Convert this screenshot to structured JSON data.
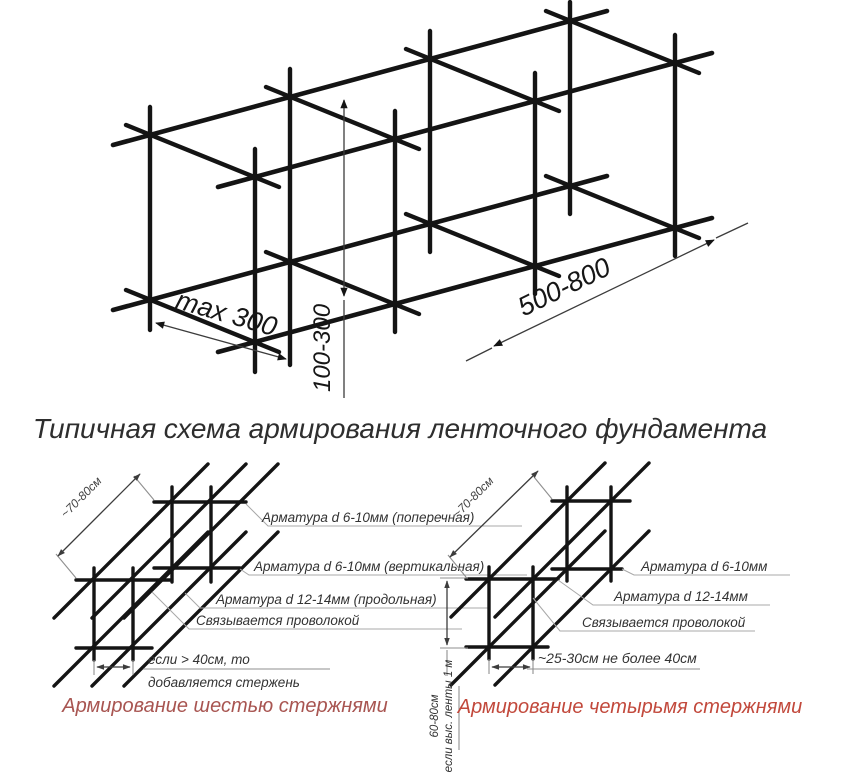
{
  "page": {
    "background": "#ffffff",
    "title": "Типичная схема армирования ленточного фундамента"
  },
  "colors": {
    "ink": "#141414",
    "label_text": "#333333",
    "dim_line": "#3c3c3c",
    "callout_line": "#a8a8a8",
    "title_text": "#2e2e2e",
    "caption_left": "#a85551",
    "caption_right": "#c2493c"
  },
  "top_figure": {
    "description": "isometric-rebar-cage-sketch",
    "dims": {
      "transverse_spacing": "max 300",
      "vertical_spacing": "100-300",
      "frame_spacing": "500-800"
    }
  },
  "left_diagram": {
    "caption": "Армирование шестью стержнями",
    "labels": {
      "transverse": "Арматура d 6-10мм (поперечная)",
      "vertical": "Арматура d 6-10мм (вертикальная)",
      "longitudinal": "Арматура d 12-14мм (продольная)",
      "wire": "Связывается проволокой",
      "extra_rod_line1": "если > 40см, то",
      "extra_rod_line2": "добавляется стержень",
      "frame_spacing": "~70-80см"
    }
  },
  "right_diagram": {
    "caption": "Армирование четырьмя стержнями",
    "labels": {
      "transverse": "Арматура d 6-10мм",
      "longitudinal": "Арматура d 12-14мм",
      "wire": "Связывается проволокой",
      "bottom_spacing": "~25-30см не более 40см",
      "frame_spacing": "~70-80см",
      "height_line1": "60-80см",
      "height_line2": "если выс. ленты 1 м"
    }
  }
}
